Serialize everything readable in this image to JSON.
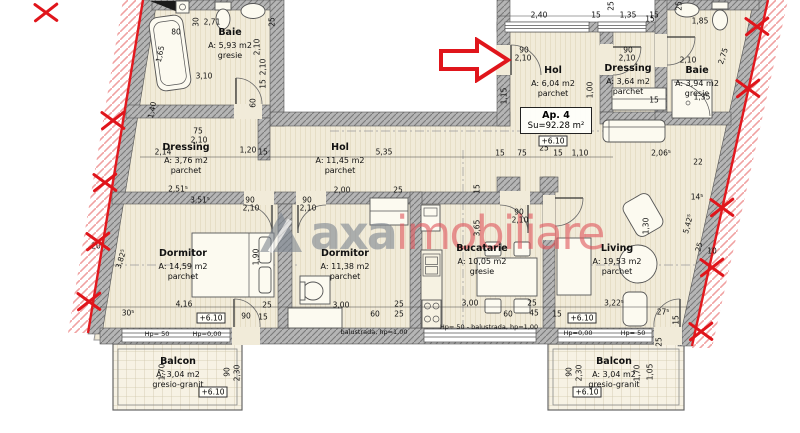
{
  "apartment": {
    "label": "Ap. 4",
    "area": "Su=92.28 m²"
  },
  "watermark": {
    "brand": "axa",
    "suffix": "imobiliare"
  },
  "rooms": [
    {
      "name": "Baie",
      "area": "A: 5,93 m2",
      "floor": "gresie",
      "x": 230,
      "y": 27
    },
    {
      "name": "Dressing",
      "area": "A: 3,76 m2",
      "floor": "parchet",
      "x": 186,
      "y": 142
    },
    {
      "name": "Hol",
      "area": "A: 11,45 m2",
      "floor": "parchet",
      "x": 340,
      "y": 142
    },
    {
      "name": "Hol",
      "area": "A: 6,04 m2",
      "floor": "parchet",
      "x": 553,
      "y": 65
    },
    {
      "name": "Dressing",
      "area": "A: 3,64 m2",
      "floor": "parchet",
      "x": 628,
      "y": 63
    },
    {
      "name": "Baie",
      "area": "A: 3,94 m2",
      "floor": "gresie",
      "x": 697,
      "y": 65
    },
    {
      "name": "Dormitor",
      "area": "A: 14,59 m2",
      "floor": "parchet",
      "x": 183,
      "y": 248
    },
    {
      "name": "Dormitor",
      "area": "A: 11,38 m2",
      "floor": "parchet",
      "x": 345,
      "y": 248
    },
    {
      "name": "Bucatarie",
      "area": "A: 10,05 m2",
      "floor": "gresie",
      "x": 482,
      "y": 243
    },
    {
      "name": "Living",
      "area": "A: 19,53 m2",
      "floor": "parchet",
      "x": 617,
      "y": 243
    },
    {
      "name": "Balcon",
      "area": "A: 3,04 m2",
      "floor": "gresio-granit",
      "x": 178,
      "y": 356
    },
    {
      "name": "Balcon",
      "area": "A: 3,04 m2",
      "floor": "gresio-granit",
      "x": 614,
      "y": 356
    }
  ],
  "level_markers": [
    {
      "t": "+6.10",
      "x": 553,
      "y": 141
    },
    {
      "t": "+6.10",
      "x": 211,
      "y": 318
    },
    {
      "t": "+6.10",
      "x": 582,
      "y": 318
    },
    {
      "t": "+6.10",
      "x": 213,
      "y": 392
    },
    {
      "t": "+6.10",
      "x": 587,
      "y": 392
    }
  ],
  "notes": [
    {
      "t": "Hp= 50",
      "x": 157,
      "y": 334
    },
    {
      "t": "Hp=0,00",
      "x": 207,
      "y": 334
    },
    {
      "t": "Hp= 50 - balustrada, hp=1,00",
      "x": 489,
      "y": 327
    },
    {
      "t": "balustrada, hp=1,00",
      "x": 374,
      "y": 332
    },
    {
      "t": "Hp=0,00",
      "x": 578,
      "y": 333
    },
    {
      "t": "Hp= 50",
      "x": 633,
      "y": 333
    }
  ],
  "dims": [
    {
      "t": "2,71",
      "x": 212,
      "y": 22
    },
    {
      "t": "30",
      "x": 196,
      "y": 22,
      "r": -90
    },
    {
      "t": "25",
      "x": 272,
      "y": 22,
      "r": -90
    },
    {
      "t": "80",
      "x": 176,
      "y": 32
    },
    {
      "t": "2,10",
      "x": 257,
      "y": 47,
      "r": -90
    },
    {
      "t": "3,10",
      "x": 204,
      "y": 76
    },
    {
      "t": "1,65",
      "x": 160,
      "y": 54,
      "r": -78
    },
    {
      "t": "2,10",
      "x": 263,
      "y": 67,
      "r": -90
    },
    {
      "t": "15",
      "x": 263,
      "y": 84,
      "r": -90
    },
    {
      "t": "60",
      "x": 253,
      "y": 103,
      "r": -90
    },
    {
      "t": "1,40",
      "x": 152,
      "y": 110,
      "r": -78
    },
    {
      "t": "2,40",
      "x": 539,
      "y": 15
    },
    {
      "t": "15",
      "x": 596,
      "y": 15
    },
    {
      "t": "1,35",
      "x": 628,
      "y": 15
    },
    {
      "t": "15",
      "x": 654,
      "y": 15
    },
    {
      "t": "25",
      "x": 611,
      "y": 6,
      "r": -90
    },
    {
      "t": "25",
      "x": 679,
      "y": 6,
      "r": -90
    },
    {
      "t": "90",
      "x": 524,
      "y": 50
    },
    {
      "t": "2,10",
      "x": 523,
      "y": 58
    },
    {
      "t": "90",
      "x": 628,
      "y": 50
    },
    {
      "t": "2,10",
      "x": 627,
      "y": 58
    },
    {
      "t": "1,15",
      "x": 504,
      "y": 96,
      "r": -90
    },
    {
      "t": "1,00",
      "x": 590,
      "y": 90,
      "r": -90
    },
    {
      "t": "15",
      "x": 654,
      "y": 100
    },
    {
      "t": "1,85",
      "x": 700,
      "y": 21
    },
    {
      "t": "2,10",
      "x": 688,
      "y": 60
    },
    {
      "t": "1,35",
      "x": 702,
      "y": 97
    },
    {
      "t": "2,75",
      "x": 723,
      "y": 56,
      "r": -72
    },
    {
      "t": "15",
      "x": 650,
      "y": 19
    },
    {
      "t": "5,35",
      "x": 384,
      "y": 152
    },
    {
      "t": "1,20",
      "x": 248,
      "y": 150
    },
    {
      "t": "15",
      "x": 263,
      "y": 152
    },
    {
      "t": "75",
      "x": 198,
      "y": 131
    },
    {
      "t": "2,10",
      "x": 199,
      "y": 140
    },
    {
      "t": "2,14",
      "x": 163,
      "y": 152
    },
    {
      "t": "2,51⁵",
      "x": 178,
      "y": 189
    },
    {
      "t": "3,51⁵",
      "x": 200,
      "y": 200
    },
    {
      "t": "15",
      "x": 500,
      "y": 153
    },
    {
      "t": "75",
      "x": 522,
      "y": 153
    },
    {
      "t": "25",
      "x": 544,
      "y": 148
    },
    {
      "t": "15",
      "x": 558,
      "y": 153
    },
    {
      "t": "1,10",
      "x": 580,
      "y": 153
    },
    {
      "t": "2,06⁵",
      "x": 661,
      "y": 153
    },
    {
      "t": "22",
      "x": 698,
      "y": 162
    },
    {
      "t": "14⁵",
      "x": 697,
      "y": 197
    },
    {
      "t": "2,00",
      "x": 342,
      "y": 190
    },
    {
      "t": "25",
      "x": 398,
      "y": 190
    },
    {
      "t": "90",
      "x": 250,
      "y": 200
    },
    {
      "t": "2,10",
      "x": 251,
      "y": 208
    },
    {
      "t": "90",
      "x": 307,
      "y": 200
    },
    {
      "t": "2,10",
      "x": 308,
      "y": 208
    },
    {
      "t": "90",
      "x": 519,
      "y": 212
    },
    {
      "t": "2,10",
      "x": 520,
      "y": 220
    },
    {
      "t": "4,16",
      "x": 184,
      "y": 304
    },
    {
      "t": "3,82⁵",
      "x": 121,
      "y": 259,
      "r": -72
    },
    {
      "t": "30⁵",
      "x": 128,
      "y": 313
    },
    {
      "t": "20",
      "x": 96,
      "y": 246
    },
    {
      "t": "1,90",
      "x": 256,
      "y": 257,
      "r": -90
    },
    {
      "t": "25",
      "x": 267,
      "y": 305
    },
    {
      "t": "90",
      "x": 246,
      "y": 316
    },
    {
      "t": "15",
      "x": 263,
      "y": 317
    },
    {
      "t": "3,00",
      "x": 341,
      "y": 305
    },
    {
      "t": "60",
      "x": 375,
      "y": 314
    },
    {
      "t": "25",
      "x": 399,
      "y": 304
    },
    {
      "t": "25",
      "x": 399,
      "y": 314
    },
    {
      "t": "3,00",
      "x": 470,
      "y": 303
    },
    {
      "t": "60",
      "x": 508,
      "y": 314
    },
    {
      "t": "25",
      "x": 532,
      "y": 303
    },
    {
      "t": "45",
      "x": 534,
      "y": 313
    },
    {
      "t": "15",
      "x": 557,
      "y": 314
    },
    {
      "t": "3,65",
      "x": 477,
      "y": 228,
      "r": -90
    },
    {
      "t": "15",
      "x": 477,
      "y": 189,
      "r": -90
    },
    {
      "t": "1,30",
      "x": 646,
      "y": 226,
      "r": -90
    },
    {
      "t": "3,22⁵",
      "x": 614,
      "y": 303
    },
    {
      "t": "27⁵",
      "x": 663,
      "y": 312
    },
    {
      "t": "5,42⁵",
      "x": 688,
      "y": 224,
      "r": -75
    },
    {
      "t": "25",
      "x": 699,
      "y": 247,
      "r": -75
    },
    {
      "t": "10",
      "x": 712,
      "y": 251
    },
    {
      "t": "15",
      "x": 676,
      "y": 320,
      "r": -90
    },
    {
      "t": "1,70",
      "x": 162,
      "y": 372,
      "r": -90
    },
    {
      "t": "90",
      "x": 227,
      "y": 372,
      "r": -90
    },
    {
      "t": "2,30",
      "x": 237,
      "y": 373,
      "r": -90
    },
    {
      "t": "90",
      "x": 569,
      "y": 372,
      "r": -90
    },
    {
      "t": "2,30",
      "x": 579,
      "y": 373,
      "r": -90
    },
    {
      "t": "1,70",
      "x": 637,
      "y": 373,
      "r": -90
    },
    {
      "t": "1,05",
      "x": 650,
      "y": 372,
      "r": -90
    },
    {
      "t": "25",
      "x": 659,
      "y": 342,
      "r": -90
    }
  ],
  "xmarks": [
    {
      "x": 46,
      "y": 12
    },
    {
      "x": 113,
      "y": 120
    },
    {
      "x": 105,
      "y": 182
    },
    {
      "x": 98,
      "y": 241
    },
    {
      "x": 89,
      "y": 301
    },
    {
      "x": 757,
      "y": 26
    },
    {
      "x": 748,
      "y": 88
    },
    {
      "x": 722,
      "y": 207
    },
    {
      "x": 712,
      "y": 267
    },
    {
      "x": 701,
      "y": 331
    }
  ]
}
